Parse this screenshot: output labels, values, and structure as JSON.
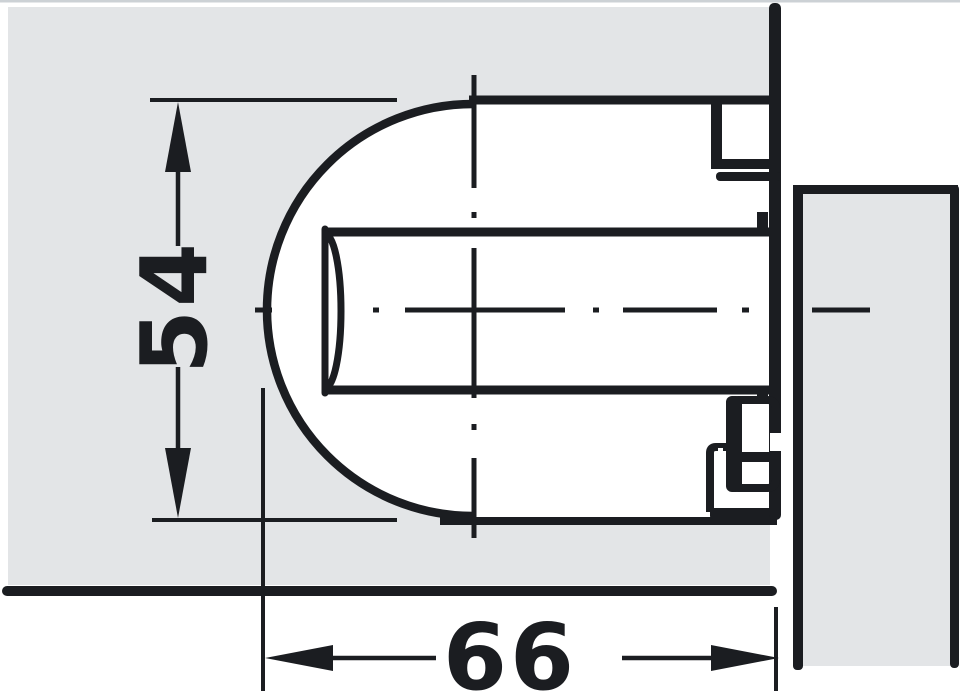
{
  "drawing": {
    "dimensions": {
      "height_label": "54",
      "width_label": "66"
    },
    "colors": {
      "panel_fill": "#e3e5e7",
      "line": "#1b1d21",
      "background": "#ffffff",
      "top_edge": "#ccd1d5"
    }
  }
}
